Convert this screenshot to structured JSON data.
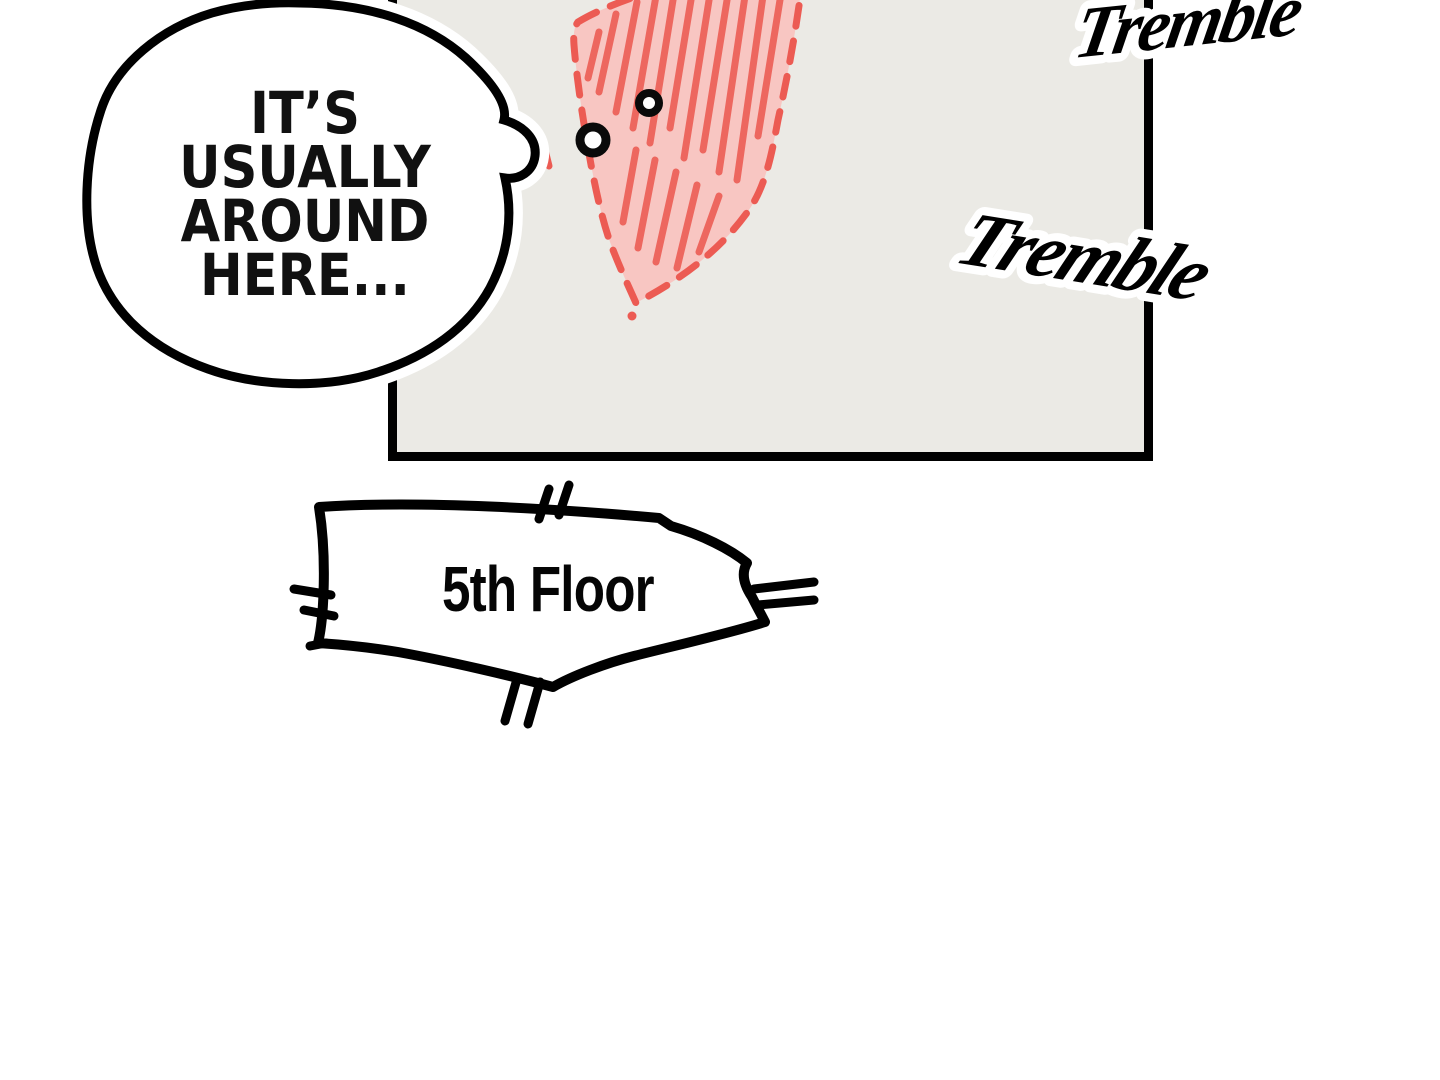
{
  "panel": {
    "background": "#ebeae5",
    "border_color": "#000000"
  },
  "speech_bubble": {
    "lines": [
      "IT’S",
      "USUALLY",
      "AROUND",
      "HERE..."
    ],
    "fill": "#ffffff",
    "outline": "#000000"
  },
  "map_region": {
    "fill": "#f8c6c2",
    "hatch_color": "#ed675f",
    "outline_color": "#ec5b53"
  },
  "markers": {
    "fill": "#ffffff",
    "ring_color": "#0a0a0a"
  },
  "sfx": {
    "top": "Tremble",
    "middle": "Tremble",
    "color": "#000000",
    "halo": "#ffffff"
  },
  "floor_sign": {
    "label": "5th Floor",
    "fill": "#ffffff",
    "outline": "#000000"
  }
}
